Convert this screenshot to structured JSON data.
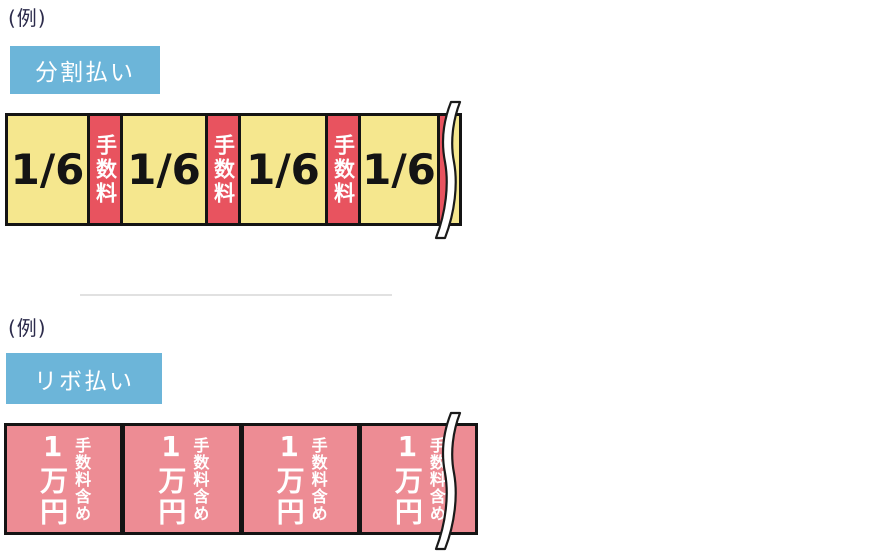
{
  "sections": [
    {
      "example_label": "(例)",
      "method": "分割払い",
      "bar": {
        "type": "installment",
        "continuation": "torn-edge",
        "segments": [
          {
            "kind": "payment",
            "label": "1/6"
          },
          {
            "kind": "fee",
            "label": "手数料"
          },
          {
            "kind": "payment",
            "label": "1/6"
          },
          {
            "kind": "fee",
            "label": "手数料"
          },
          {
            "kind": "payment",
            "label": "1/6"
          },
          {
            "kind": "fee",
            "label": "手数料"
          },
          {
            "kind": "payment",
            "label": "1/6"
          },
          {
            "kind": "fee",
            "label": ""
          },
          {
            "kind": "payment",
            "label": ""
          }
        ]
      }
    },
    {
      "example_label": "(例)",
      "method": "リボ払い",
      "bar": {
        "type": "revolving",
        "continuation": "torn-edge",
        "segments": [
          {
            "amount": "1万円",
            "note": "手数料含め"
          },
          {
            "amount": "1万円",
            "note": "手数料含め"
          },
          {
            "amount": "1万円",
            "note": "手数料含め"
          },
          {
            "amount": "1万円",
            "note": "手数料含め"
          }
        ]
      }
    }
  ],
  "colors": {
    "badge_blue": "#6CB5D9",
    "installment_yellow": "#F5E78E",
    "fee_red": "#E8535F",
    "revolving_pink": "#ED8C94",
    "label_navy": "#2D2C4C",
    "border_black": "#141414"
  }
}
